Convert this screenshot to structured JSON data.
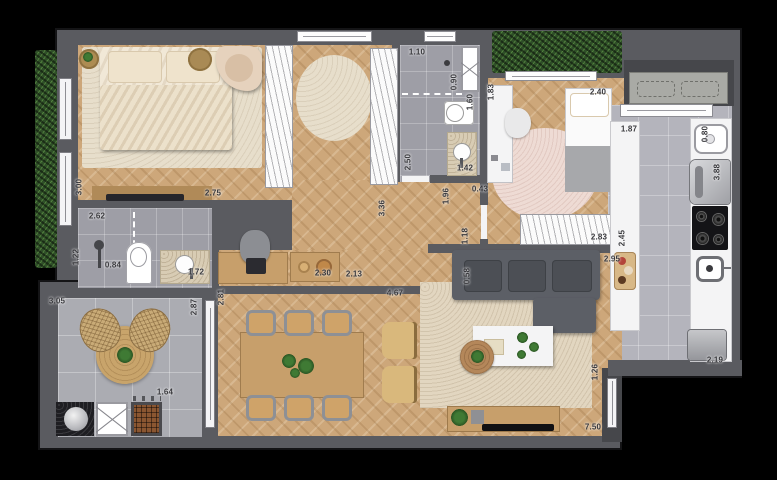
{
  "plan": {
    "type": "apartment-floor-plan",
    "unit_hint": "meters",
    "palette": {
      "background": "#000000",
      "wall": "#5a5b60",
      "wall_dark": "#46474b",
      "wood": "#cda77a",
      "tile_bath": "#9e9ea6",
      "tile_balcony": "#abacb2",
      "tile_kitchen": "#b4b4bc",
      "rug_beige": "#e7decb",
      "rug_living": "#e2d6c0",
      "rug_pink": "#eedbd4",
      "hedge": "#2f4f28",
      "counter": "#f4f4f5",
      "sofa": "#5c5f66",
      "table_wood": "#c79f6b",
      "chair_tan": "#cfa369",
      "label": "#38383c"
    }
  },
  "dimension_labels": [
    {
      "t": "3.00",
      "x": 79,
      "y": 187,
      "v": true
    },
    {
      "t": "2.75",
      "x": 213,
      "y": 193,
      "v": false
    },
    {
      "t": "2.62",
      "x": 97,
      "y": 216,
      "v": false
    },
    {
      "t": "1.22",
      "x": 76,
      "y": 257,
      "v": true
    },
    {
      "t": "0.84",
      "x": 113,
      "y": 265,
      "v": false
    },
    {
      "t": "1.72",
      "x": 196,
      "y": 272,
      "v": false
    },
    {
      "t": "1.10",
      "x": 417,
      "y": 52,
      "v": false
    },
    {
      "t": "0.90",
      "x": 454,
      "y": 82,
      "v": true
    },
    {
      "t": "1.60",
      "x": 470,
      "y": 102,
      "v": true
    },
    {
      "t": "1.83",
      "x": 491,
      "y": 92,
      "v": true
    },
    {
      "t": "2.50",
      "x": 408,
      "y": 162,
      "v": true
    },
    {
      "t": "1.42",
      "x": 465,
      "y": 168,
      "v": false
    },
    {
      "t": "3.36",
      "x": 382,
      "y": 208,
      "v": true
    },
    {
      "t": "1.96",
      "x": 446,
      "y": 196,
      "v": true
    },
    {
      "t": "0.43",
      "x": 480,
      "y": 189,
      "v": false
    },
    {
      "t": "1.18",
      "x": 465,
      "y": 236,
      "v": true
    },
    {
      "t": "2.40",
      "x": 598,
      "y": 92,
      "v": false
    },
    {
      "t": "1.87",
      "x": 629,
      "y": 129,
      "v": false
    },
    {
      "t": "0.80",
      "x": 705,
      "y": 134,
      "v": true
    },
    {
      "t": "3.88",
      "x": 717,
      "y": 172,
      "v": true
    },
    {
      "t": "2.83",
      "x": 599,
      "y": 237,
      "v": false
    },
    {
      "t": "2.45",
      "x": 622,
      "y": 238,
      "v": true
    },
    {
      "t": "2.95",
      "x": 612,
      "y": 259,
      "v": false
    },
    {
      "t": "2.19",
      "x": 715,
      "y": 360,
      "v": false
    },
    {
      "t": "1.26",
      "x": 595,
      "y": 372,
      "v": true
    },
    {
      "t": "0.58",
      "x": 467,
      "y": 276,
      "v": true
    },
    {
      "t": "7.50",
      "x": 593,
      "y": 427,
      "v": false
    },
    {
      "t": "4.67",
      "x": 395,
      "y": 293,
      "v": false
    },
    {
      "t": "2.30",
      "x": 323,
      "y": 273,
      "v": false
    },
    {
      "t": "2.13",
      "x": 354,
      "y": 274,
      "v": false
    },
    {
      "t": "2.81",
      "x": 221,
      "y": 297,
      "v": true
    },
    {
      "t": "2.87",
      "x": 194,
      "y": 307,
      "v": true
    },
    {
      "t": "3.05",
      "x": 57,
      "y": 301,
      "v": false
    },
    {
      "t": "1.64",
      "x": 165,
      "y": 392,
      "v": false
    }
  ]
}
